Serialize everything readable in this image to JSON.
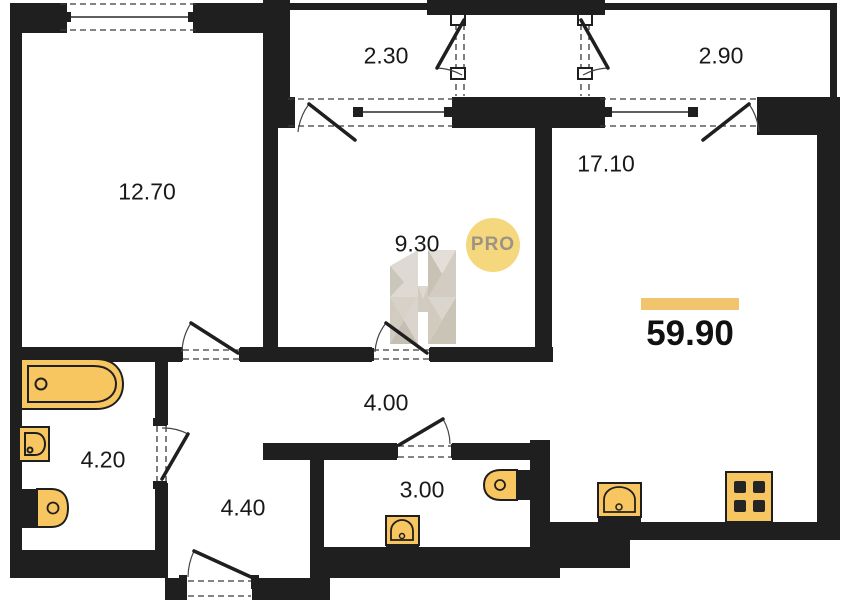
{
  "plan": {
    "total_area": "59.90",
    "watermark": {
      "badge": "PRO",
      "letter": "H"
    },
    "rooms": [
      {
        "id": "bedroom",
        "area": "12.70"
      },
      {
        "id": "balcony-left",
        "area": "2.30"
      },
      {
        "id": "balcony-right",
        "area": "2.90"
      },
      {
        "id": "living-kitchen",
        "area": "17.10"
      },
      {
        "id": "room-middle",
        "area": "9.30"
      },
      {
        "id": "corridor",
        "area": "4.00"
      },
      {
        "id": "bathroom",
        "area": "4.20"
      },
      {
        "id": "hallway",
        "area": "4.40"
      },
      {
        "id": "wc",
        "area": "3.00"
      }
    ],
    "colors": {
      "wall": "#1f1f1f",
      "fixture": "#f8c660",
      "accent_bar": "#f2c46d",
      "badge_bg": "#f5d77e",
      "badge_text": "#9c9385"
    }
  }
}
